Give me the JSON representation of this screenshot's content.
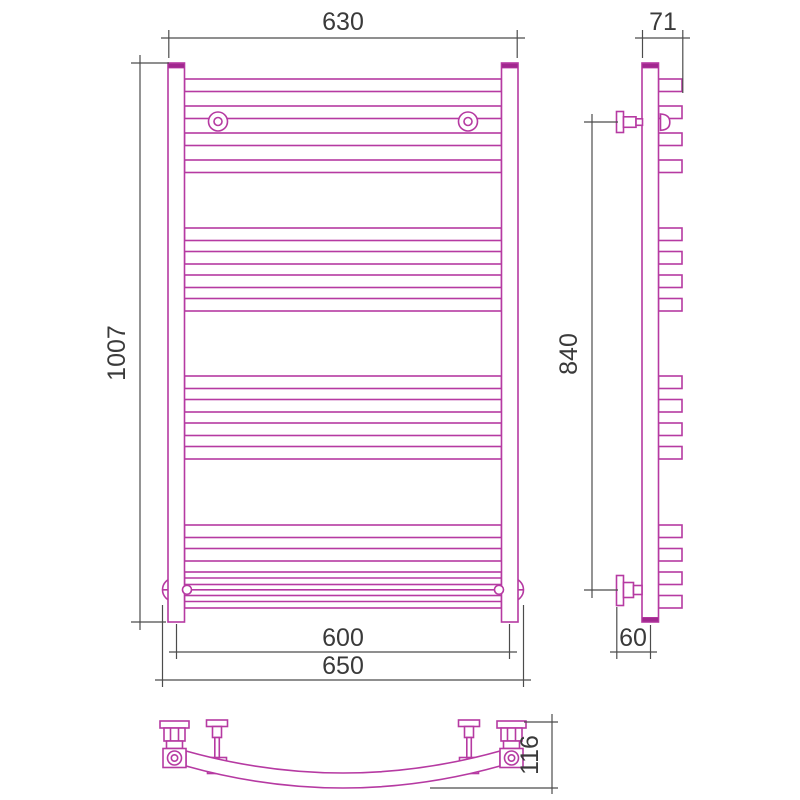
{
  "drawing": {
    "kind": "towel-rail three-view dimension drawing",
    "views": {
      "front": {
        "label": "front-view",
        "dimensions": {
          "top_width": "630",
          "height": "1007",
          "bottom_axis_width": "600",
          "bottom_overall_width": "650"
        }
      },
      "side": {
        "label": "side-view",
        "dimensions": {
          "top_depth": "71",
          "bracket_span": "840",
          "wall_offset": "60"
        }
      },
      "bottom": {
        "label": "bottom-view",
        "dimensions": {
          "depth": "116"
        }
      }
    },
    "structure": {
      "rail_groups": 4,
      "rails_per_group": 4,
      "total_rails": 16,
      "front_wall_brackets": 2,
      "side_wall_brackets": 2
    }
  },
  "geometry": {
    "rail_tops_y": [
      79,
      106,
      133,
      160,
      228,
      251.5,
      275,
      298.5,
      376,
      399.5,
      423,
      446.5,
      525,
      548.5,
      572,
      595.5
    ],
    "rail_height": 12.5,
    "front_rail_x": 184.5,
    "front_rail_width": 317,
    "side_tab_x": 658.5,
    "side_tab_width": 23.5
  },
  "colors": {
    "product_outline": "#b63aa2",
    "product_fill": "#ffffff",
    "accent_fill": "#a1288f",
    "dimension_line": "#4c4c4c",
    "dimension_text": "#3a3a3a",
    "background": "#ffffff"
  }
}
